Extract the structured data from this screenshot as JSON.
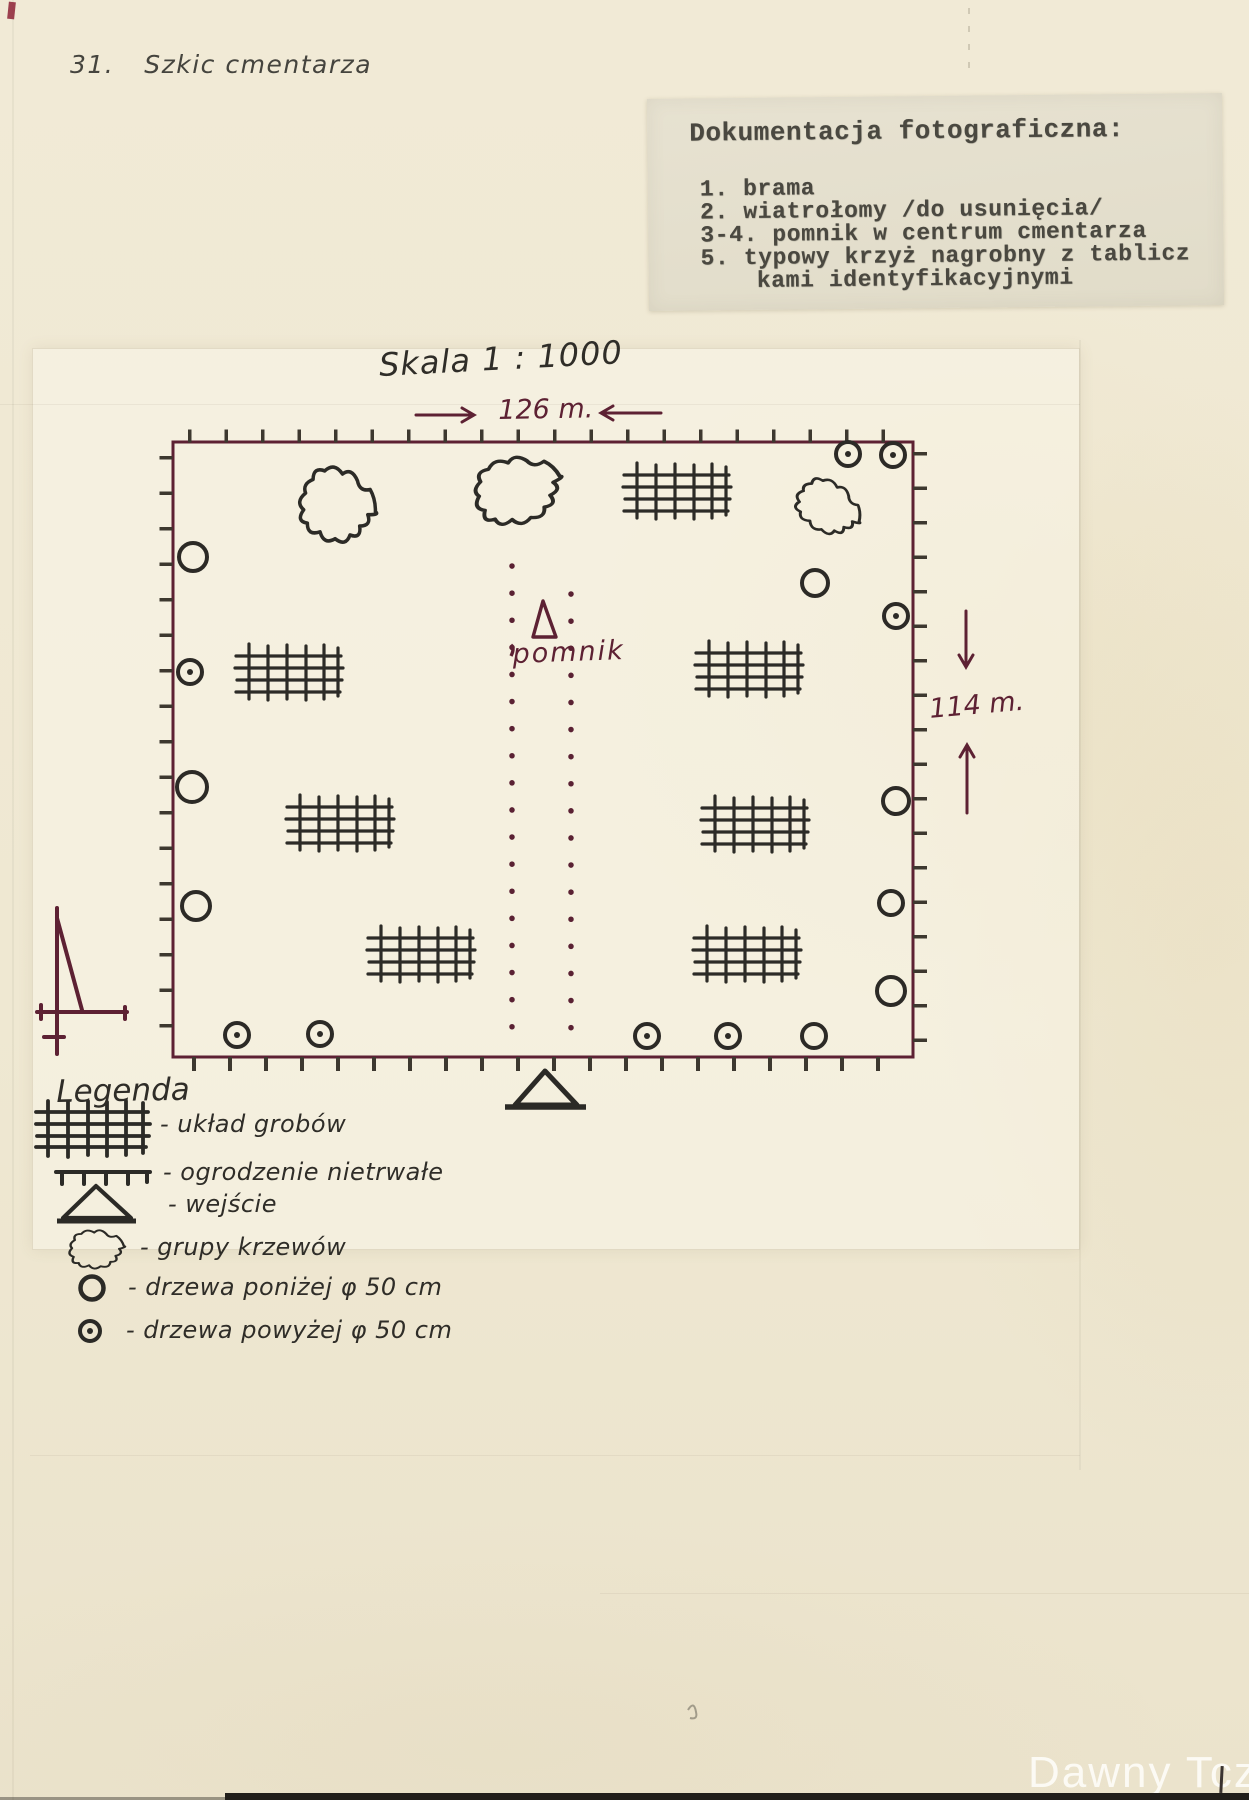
{
  "page": {
    "header_number": "31.",
    "header_title": "Szkic cmentarza",
    "watermark": "Dawny Tczew"
  },
  "note": {
    "title": "Dokumentacja fotograficzna:",
    "lines": [
      "1. brama",
      "2. wiatrołomy /do usunięcia/",
      "3-4. pomnik w centrum cmentarza",
      "5. typowy krzyż nagrobny z tablicz",
      "kami identyfikacyjnymi"
    ]
  },
  "map": {
    "scale_label": "Skala 1 : 1000",
    "width_label": "126 m.",
    "height_label": "114 m.",
    "monument_label": "pomnik",
    "features": {
      "grave_plot_grids": 7,
      "shrub_groups": 3,
      "trees_below_50cm": 8,
      "trees_above_50cm": 8,
      "monument": "pomnik (triangle, center)",
      "entrance": "triangle on south edge",
      "dimensions": "126 m × 114 m",
      "scale": "1:1000"
    }
  },
  "legend": {
    "title": "Legenda",
    "items": [
      {
        "symbol": "grave-grid-icon",
        "label": "- układ grobów"
      },
      {
        "symbol": "temporary-fence-icon",
        "label": "- ogrodzenie nietrwałe"
      },
      {
        "symbol": "entrance-triangle-icon",
        "label": "- wejście"
      },
      {
        "symbol": "shrub-group-icon",
        "label": "- grupy krzewów"
      },
      {
        "symbol": "tree-below-50-icon",
        "label": "- drzewa poniżej φ 50 cm"
      },
      {
        "symbol": "tree-above-50-icon",
        "label": "- drzewa powyżej φ 50 cm"
      }
    ]
  },
  "colors": {
    "paper": "#efe8d3",
    "maroon_ink": "#5d2133",
    "black_ink": "#2f2d28",
    "typed_ink": "#4a4840"
  }
}
